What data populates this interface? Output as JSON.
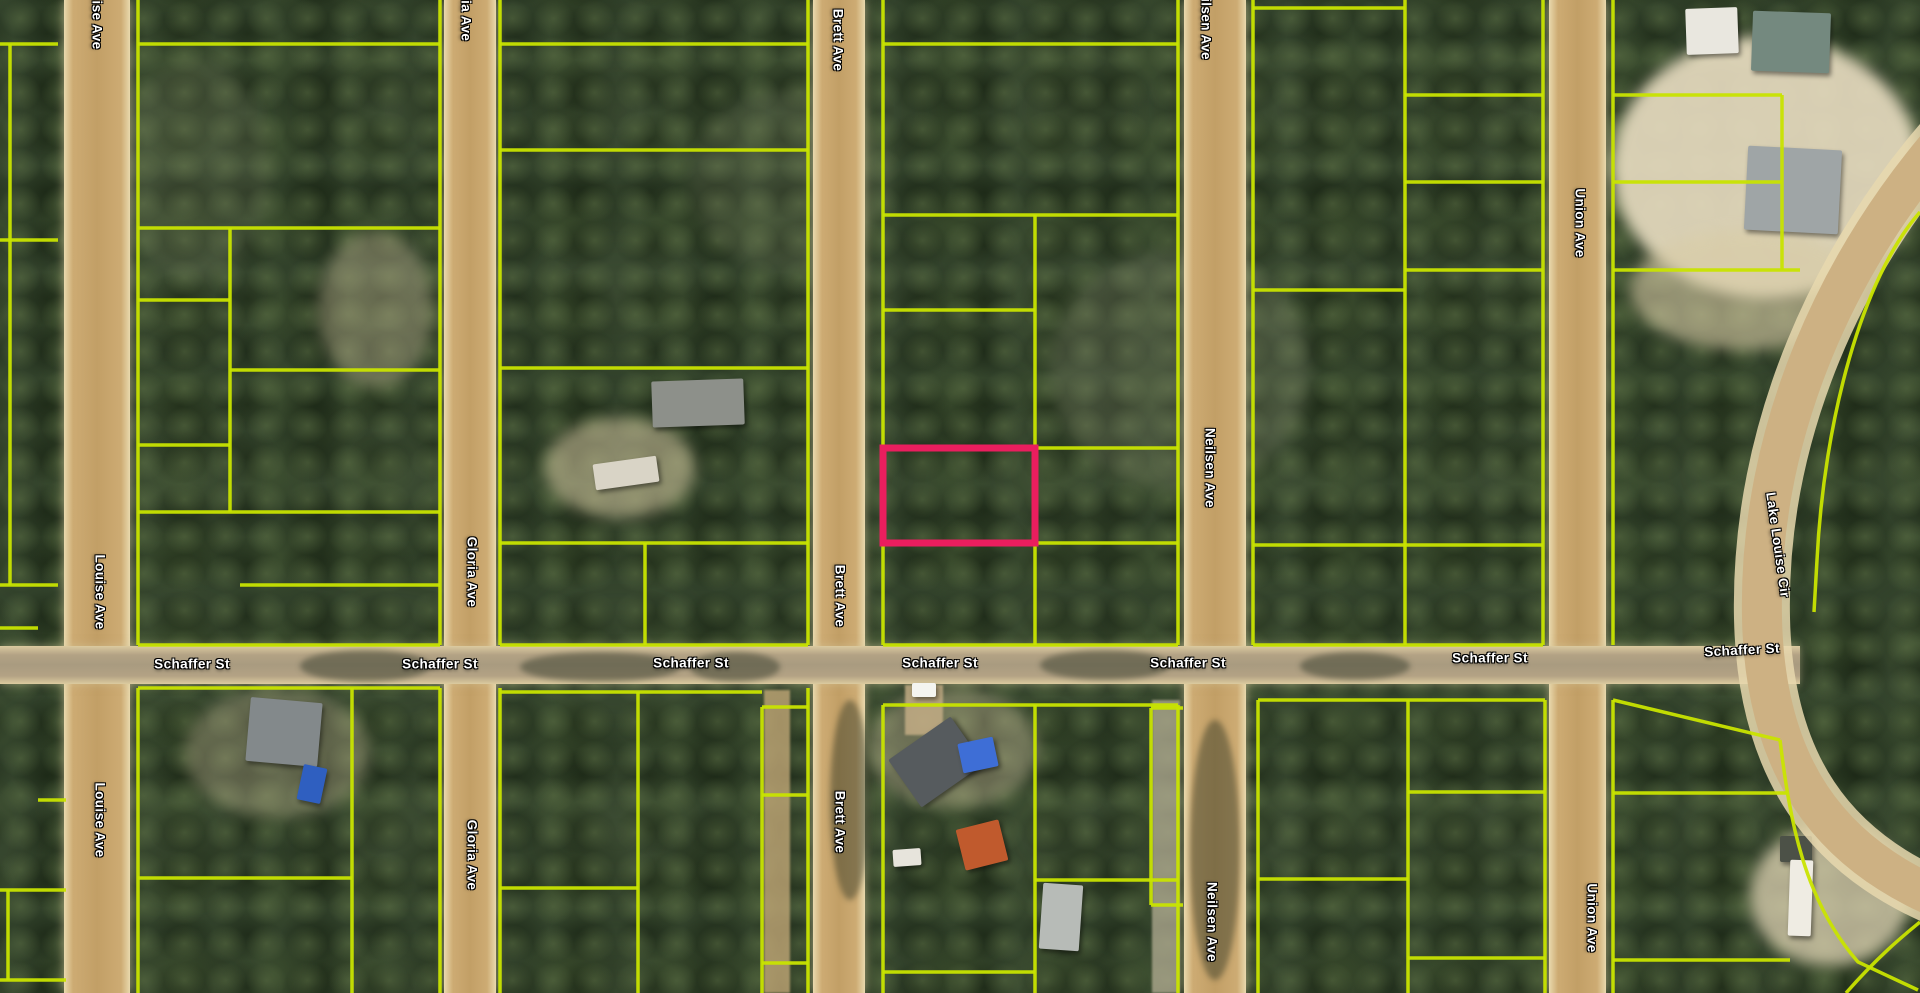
{
  "canvas": {
    "width": 1920,
    "height": 993
  },
  "colors": {
    "parcel_line": "#c9e400",
    "highlight": "#ea1e5e",
    "road_fill": "#cdb183",
    "road_shoulder": "#e7d8ae",
    "label_text": "#ffffff",
    "label_outline": "#000000"
  },
  "highlight_parcel": {
    "x": 883,
    "y": 448,
    "w": 152,
    "h": 95,
    "stroke_width": 7
  },
  "roads": {
    "vertical": [
      {
        "name": "Louise Ave",
        "x": 64,
        "width": 66
      },
      {
        "name": "Gloria Ave",
        "x": 444,
        "width": 52
      },
      {
        "name": "Brett Ave",
        "x": 813,
        "width": 52
      },
      {
        "name": "Neilsen Ave",
        "x": 1184,
        "width": 62
      },
      {
        "name": "Union Ave",
        "x": 1549,
        "width": 57
      }
    ],
    "horizontal": [
      {
        "name": "Schaffer St",
        "x": 0,
        "y": 646,
        "width": 1800,
        "height": 38
      }
    ],
    "curved": [
      {
        "name": "Lake Louise Cir",
        "path": "M 1952 130 C 1840 255 1758 430 1762 618 C 1765 762 1825 856 1955 905",
        "width": 40
      }
    ]
  },
  "street_labels": [
    {
      "text": "Schaffer St",
      "x": 192,
      "y": 664,
      "rot": 0
    },
    {
      "text": "Schaffer St",
      "x": 440,
      "y": 664,
      "rot": 0
    },
    {
      "text": "Schaffer St",
      "x": 691,
      "y": 663,
      "rot": 0
    },
    {
      "text": "Schaffer St",
      "x": 940,
      "y": 663,
      "rot": 0
    },
    {
      "text": "Schaffer St",
      "x": 1188,
      "y": 663,
      "rot": 0
    },
    {
      "text": "Schaffer St",
      "x": 1490,
      "y": 658,
      "rot": 0
    },
    {
      "text": "Schaffer St",
      "x": 1742,
      "y": 650,
      "rot": -3
    },
    {
      "text": "Louise Ave",
      "x": 97,
      "y": 12,
      "rot": 90
    },
    {
      "text": "Louise Ave",
      "x": 100,
      "y": 592,
      "rot": 90
    },
    {
      "text": "Louise Ave",
      "x": 100,
      "y": 820,
      "rot": 90
    },
    {
      "text": "Gloria Ave",
      "x": 466,
      "y": 6,
      "rot": 90
    },
    {
      "text": "Gloria Ave",
      "x": 472,
      "y": 572,
      "rot": 90
    },
    {
      "text": "Gloria Ave",
      "x": 472,
      "y": 855,
      "rot": 90
    },
    {
      "text": "Brett Ave",
      "x": 838,
      "y": 40,
      "rot": 90
    },
    {
      "text": "Brett Ave",
      "x": 840,
      "y": 596,
      "rot": 90
    },
    {
      "text": "Brett Ave",
      "x": 840,
      "y": 822,
      "rot": 90
    },
    {
      "text": "Neilsen Ave",
      "x": 1206,
      "y": 20,
      "rot": 90
    },
    {
      "text": "Neilsen Ave",
      "x": 1210,
      "y": 468,
      "rot": 90
    },
    {
      "text": "Neilsen Ave",
      "x": 1212,
      "y": 922,
      "rot": 90
    },
    {
      "text": "Union Ave",
      "x": 1580,
      "y": 223,
      "rot": 90
    },
    {
      "text": "Union Ave",
      "x": 1592,
      "y": 918,
      "rot": 90
    },
    {
      "text": "Lake Louise Cir",
      "x": 1778,
      "y": 545,
      "rot": 82
    }
  ],
  "parcel_lines": [
    [
      0,
      44,
      58,
      44
    ],
    [
      10,
      44,
      10,
      240
    ],
    [
      0,
      240,
      58,
      240
    ],
    [
      10,
      240,
      10,
      585
    ],
    [
      0,
      585,
      58,
      585
    ],
    [
      0,
      628,
      38,
      628
    ],
    [
      38,
      800,
      66,
      800
    ],
    [
      0,
      890,
      66,
      890
    ],
    [
      8,
      890,
      8,
      980
    ],
    [
      0,
      980,
      66,
      980
    ],
    [
      138,
      0,
      138,
      645
    ],
    [
      440,
      0,
      440,
      645
    ],
    [
      138,
      645,
      440,
      645
    ],
    [
      138,
      44,
      440,
      44
    ],
    [
      138,
      228,
      440,
      228
    ],
    [
      138,
      300,
      230,
      300
    ],
    [
      230,
      228,
      230,
      512
    ],
    [
      230,
      370,
      440,
      370
    ],
    [
      138,
      445,
      230,
      445
    ],
    [
      138,
      512,
      440,
      512
    ],
    [
      240,
      585,
      440,
      585
    ],
    [
      138,
      688,
      138,
      993
    ],
    [
      440,
      688,
      440,
      993
    ],
    [
      138,
      688,
      440,
      688
    ],
    [
      352,
      688,
      352,
      993
    ],
    [
      138,
      878,
      352,
      878
    ],
    [
      500,
      0,
      500,
      645
    ],
    [
      808,
      0,
      808,
      645
    ],
    [
      500,
      645,
      808,
      645
    ],
    [
      500,
      44,
      808,
      44
    ],
    [
      500,
      150,
      808,
      150
    ],
    [
      500,
      368,
      808,
      368
    ],
    [
      500,
      543,
      808,
      543
    ],
    [
      645,
      543,
      645,
      645
    ],
    [
      500,
      688,
      500,
      993
    ],
    [
      762,
      707,
      762,
      993
    ],
    [
      808,
      688,
      808,
      993
    ],
    [
      500,
      692,
      762,
      692
    ],
    [
      762,
      707,
      808,
      707
    ],
    [
      500,
      888,
      638,
      888
    ],
    [
      638,
      692,
      638,
      993
    ],
    [
      762,
      795,
      808,
      795
    ],
    [
      762,
      963,
      808,
      963
    ],
    [
      883,
      0,
      883,
      645
    ],
    [
      1178,
      0,
      1178,
      645
    ],
    [
      883,
      645,
      1178,
      645
    ],
    [
      883,
      44,
      1178,
      44
    ],
    [
      883,
      215,
      1178,
      215
    ],
    [
      1035,
      215,
      1035,
      645
    ],
    [
      883,
      310,
      1035,
      310
    ],
    [
      1035,
      448,
      1178,
      448
    ],
    [
      883,
      543,
      1178,
      543
    ],
    [
      883,
      705,
      883,
      993
    ],
    [
      1178,
      705,
      1178,
      993
    ],
    [
      883,
      705,
      1178,
      705
    ],
    [
      1035,
      705,
      1035,
      993
    ],
    [
      1035,
      880,
      1178,
      880
    ],
    [
      883,
      972,
      1035,
      972
    ],
    [
      1253,
      0,
      1253,
      645
    ],
    [
      1543,
      0,
      1543,
      645
    ],
    [
      1253,
      645,
      1543,
      645
    ],
    [
      1405,
      0,
      1405,
      645
    ],
    [
      1253,
      8,
      1405,
      8
    ],
    [
      1405,
      95,
      1543,
      95
    ],
    [
      1405,
      182,
      1543,
      182
    ],
    [
      1405,
      270,
      1543,
      270
    ],
    [
      1253,
      290,
      1405,
      290
    ],
    [
      1253,
      545,
      1543,
      545
    ],
    [
      1258,
      700,
      1258,
      993
    ],
    [
      1545,
      700,
      1545,
      993
    ],
    [
      1258,
      700,
      1545,
      700
    ],
    [
      1408,
      700,
      1408,
      993
    ],
    [
      1408,
      792,
      1545,
      792
    ],
    [
      1258,
      879,
      1408,
      879
    ],
    [
      1408,
      958,
      1545,
      958
    ],
    [
      1151,
      708,
      1183,
      708
    ],
    [
      1151,
      708,
      1151,
      905
    ],
    [
      1151,
      905,
      1183,
      905
    ],
    [
      1613,
      0,
      1613,
      645
    ],
    [
      1613,
      95,
      1782,
      95
    ],
    [
      1613,
      182,
      1782,
      182
    ],
    [
      1613,
      270,
      1800,
      270
    ],
    [
      1782,
      95,
      1782,
      270
    ],
    [
      1613,
      700,
      1613,
      993
    ],
    [
      1613,
      793,
      1788,
      793
    ],
    [
      1613,
      960,
      1790,
      960
    ]
  ],
  "parcel_curves": [
    {
      "path": "M 1613 700 L 1780 740"
    },
    {
      "path": "M 1920 212 C 1862 278 1824 420 1817 560 L 1814 612"
    },
    {
      "path": "M 1780 740 C 1790 822 1804 900 1858 962 L 1918 990"
    },
    {
      "path": "M 1846 993 C 1882 952 1908 932 1920 922"
    }
  ],
  "structures": [
    {
      "name": "white-building-topright",
      "x": 1686,
      "y": 8,
      "w": 52,
      "h": 46,
      "color": "#e9e7df",
      "rot": -2
    },
    {
      "name": "green-roof-building-topright",
      "x": 1752,
      "y": 12,
      "w": 78,
      "h": 60,
      "color": "#74897f",
      "rot": 2
    },
    {
      "name": "gray-roof-house-topright",
      "x": 1746,
      "y": 148,
      "w": 94,
      "h": 84,
      "color": "#9fa5a6",
      "rot": 3
    },
    {
      "name": "gray-barn",
      "x": 652,
      "y": 380,
      "w": 92,
      "h": 46,
      "color": "#8d908a",
      "rot": -2
    },
    {
      "name": "white-trailer-mid",
      "x": 594,
      "y": 460,
      "w": 64,
      "h": 26,
      "color": "#d9d4c6",
      "rot": -8
    },
    {
      "name": "dark-roof-house-south",
      "x": 898,
      "y": 733,
      "w": 76,
      "h": 58,
      "color": "#565b5e",
      "rot": -35
    },
    {
      "name": "blue-tarp",
      "x": 960,
      "y": 740,
      "w": 36,
      "h": 30,
      "color": "#3e6ed6",
      "rot": -12
    },
    {
      "name": "orange-roof-shed",
      "x": 960,
      "y": 824,
      "w": 44,
      "h": 42,
      "color": "#c05a2d",
      "rot": -14
    },
    {
      "name": "white-trailer-small",
      "x": 893,
      "y": 849,
      "w": 28,
      "h": 17,
      "color": "#e7e4dc",
      "rot": -4
    },
    {
      "name": "gray-mobile-home",
      "x": 1041,
      "y": 884,
      "w": 40,
      "h": 66,
      "color": "#b7bbb7",
      "rot": 4
    },
    {
      "name": "gray-roof-house-southwest",
      "x": 248,
      "y": 700,
      "w": 72,
      "h": 64,
      "color": "#83898b",
      "rot": 5
    },
    {
      "name": "blue-boat",
      "x": 300,
      "y": 766,
      "w": 24,
      "h": 36,
      "color": "#2f5fc0",
      "rot": 12
    },
    {
      "name": "white-car-schaffer",
      "x": 912,
      "y": 683,
      "w": 24,
      "h": 14,
      "color": "#f4f4f0",
      "rot": 0
    },
    {
      "name": "dark-shed-southeast",
      "x": 1780,
      "y": 836,
      "w": 32,
      "h": 26,
      "color": "#4c5147",
      "rot": 0
    },
    {
      "name": "white-trailer-southeast",
      "x": 1789,
      "y": 860,
      "w": 23,
      "h": 76,
      "color": "#efece3",
      "rot": 2
    }
  ],
  "ground_patches": [
    {
      "x": 1612,
      "y": 36,
      "w": 308,
      "h": 262,
      "color": "#e6dbbf",
      "opacity": 0.92
    },
    {
      "x": 1630,
      "y": 230,
      "w": 230,
      "h": 120,
      "color": "#d9cca6",
      "opacity": 0.6
    },
    {
      "x": 545,
      "y": 418,
      "w": 150,
      "h": 100,
      "color": "#cfc29d",
      "opacity": 0.55
    },
    {
      "x": 318,
      "y": 232,
      "w": 115,
      "h": 155,
      "color": "#c7ba98",
      "opacity": 0.38
    },
    {
      "x": 868,
      "y": 688,
      "w": 170,
      "h": 120,
      "color": "#cfc19e",
      "opacity": 0.4
    },
    {
      "x": 1750,
      "y": 826,
      "w": 160,
      "h": 140,
      "color": "#e0d4b4",
      "opacity": 0.75
    },
    {
      "x": 185,
      "y": 688,
      "w": 185,
      "h": 130,
      "color": "#c7ba98",
      "opacity": 0.35
    },
    {
      "x": 1050,
      "y": 250,
      "w": 260,
      "h": 240,
      "color": "#8e9277",
      "opacity": 0.25
    },
    {
      "x": 120,
      "y": 60,
      "w": 150,
      "h": 220,
      "color": "#87906e",
      "opacity": 0.2
    },
    {
      "x": 690,
      "y": 90,
      "w": 200,
      "h": 180,
      "color": "#88906f",
      "opacity": 0.2
    }
  ],
  "tracks": [
    {
      "x": 764,
      "y": 690,
      "w": 26,
      "h": 303,
      "color": "#c2a877",
      "opacity": 0.8
    },
    {
      "x": 1152,
      "y": 700,
      "w": 28,
      "h": 293,
      "color": "#bcb49b",
      "opacity": 0.7
    },
    {
      "x": 905,
      "y": 685,
      "w": 38,
      "h": 50,
      "color": "#c8b088",
      "opacity": 0.8
    }
  ],
  "road_shadows": [
    {
      "x": 300,
      "y": 650,
      "w": 130,
      "h": 32
    },
    {
      "x": 520,
      "y": 652,
      "w": 160,
      "h": 30
    },
    {
      "x": 690,
      "y": 652,
      "w": 90,
      "h": 30
    },
    {
      "x": 1040,
      "y": 650,
      "w": 130,
      "h": 30
    },
    {
      "x": 1300,
      "y": 652,
      "w": 110,
      "h": 28
    },
    {
      "x": 830,
      "y": 700,
      "w": 40,
      "h": 200
    },
    {
      "x": 1190,
      "y": 720,
      "w": 50,
      "h": 260
    }
  ]
}
